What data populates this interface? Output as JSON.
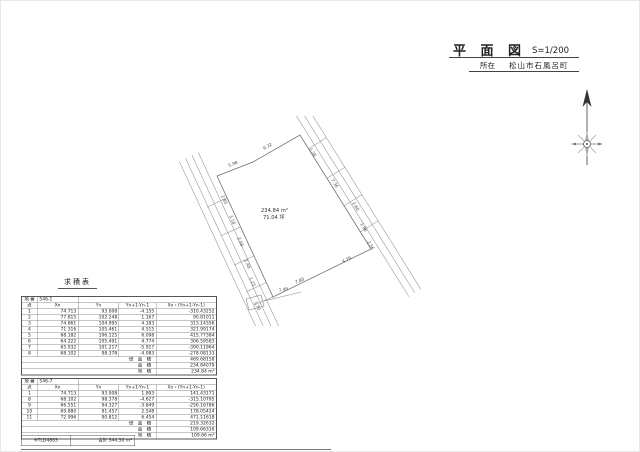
{
  "title_block": {
    "title": "平 面 図",
    "scale": "S=1/200",
    "location_label": "所在",
    "location_value": "松山市石風呂町"
  },
  "icons": {
    "compass": "north-arrow-compass"
  },
  "plot": {
    "area_m2": "234.84 m²",
    "area_tsubo": "71.04 坪",
    "dimension_labels": [
      {
        "t": "5.98",
        "x": 78,
        "y": 51,
        "r": -21
      },
      {
        "t": "9.32",
        "x": 113,
        "y": 34,
        "r": -29
      },
      {
        "t": "1.26",
        "x": 158,
        "y": 33,
        "r": 58
      },
      {
        "t": "7.36",
        "x": 180,
        "y": 64,
        "r": 58
      },
      {
        "t": "2.60",
        "x": 201,
        "y": 87,
        "r": 58
      },
      {
        "t": "1.86",
        "x": 209,
        "y": 108,
        "r": 58
      },
      {
        "t": "2.56",
        "x": 216,
        "y": 126,
        "r": 58
      },
      {
        "t": "4.79",
        "x": 192,
        "y": 147,
        "r": -26
      },
      {
        "t": "7.80",
        "x": 145,
        "y": 168,
        "r": -26
      },
      {
        "t": "2.85",
        "x": 70,
        "y": 80,
        "r": 65
      },
      {
        "t": "3.18",
        "x": 78,
        "y": 100,
        "r": 65
      },
      {
        "t": "2.08",
        "x": 86,
        "y": 122,
        "r": 65
      },
      {
        "t": "2.48",
        "x": 93,
        "y": 144,
        "r": 65
      },
      {
        "t": "1.15",
        "x": 98,
        "y": 162,
        "r": 65
      },
      {
        "t": "1.70",
        "x": 103,
        "y": 186,
        "r": 65
      },
      {
        "t": "7.49",
        "x": 128,
        "y": 176,
        "r": -13
      }
    ]
  },
  "tables_title": "求積表",
  "tables": [
    {
      "parcel_label": "地 番",
      "parcel_number": "546-1",
      "columns": [
        "点",
        "Xn",
        "Yn",
        "Yn+1-Yn-1",
        "Xn・(Yn+1-Yn-1)"
      ],
      "rows": [
        [
          "1",
          "74.713",
          "93.008",
          "-4.155",
          "-310.43252"
        ],
        [
          "2",
          "77.815",
          "102.248",
          "1.167",
          "90.81011"
        ],
        [
          "3",
          "74.861",
          "104.995",
          "4.183",
          "313.14356"
        ],
        [
          "4",
          "71.316",
          "105.461",
          "4.515",
          "321.99174"
        ],
        [
          "5",
          "68.182",
          "106.125",
          "6.098",
          "415.77384"
        ],
        [
          "6",
          "64.222",
          "105.491",
          "4.774",
          "306.59583"
        ],
        [
          "7",
          "65.932",
          "101.217",
          "-5.917",
          "-390.11964"
        ],
        [
          "8",
          "68.102",
          "98.378",
          "-4.083",
          "-278.08133"
        ]
      ],
      "summary": [
        {
          "label": "倍 面 積",
          "value": "469.68158"
        },
        {
          "label": "面 積",
          "value": "234.84079"
        },
        {
          "label": "地 積",
          "value": "234.84 m²"
        }
      ]
    },
    {
      "parcel_label": "地 番",
      "parcel_number": "546-7",
      "columns": [
        "点",
        "Xn",
        "Yn",
        "Yn+1-Yn-1",
        "Xn・(Yn+1-Yn-1)"
      ],
      "rows": [
        [
          "1",
          "74.713",
          "93.008",
          "1.893",
          "141.43171"
        ],
        [
          "8",
          "68.102",
          "98.378",
          "-4.627",
          "-315.10795"
        ],
        [
          "9",
          "66.551",
          "94.327",
          "-3.849",
          "-256.16786"
        ],
        [
          "10",
          "69.880",
          "91.457",
          "2.548",
          "178.05424"
        ],
        [
          "11",
          "72.996",
          "90.812",
          "6.454",
          "471.11618"
        ]
      ],
      "summary": [
        {
          "label": "倍 面 積",
          "value": "219.32632"
        },
        {
          "label": "面 積",
          "value": "109.66316"
        },
        {
          "label": "地 積",
          "value": "109.66 m²"
        }
      ]
    }
  ],
  "footer_box": {
    "code": "※TLD4863",
    "total": "合計 344.50 m²"
  }
}
